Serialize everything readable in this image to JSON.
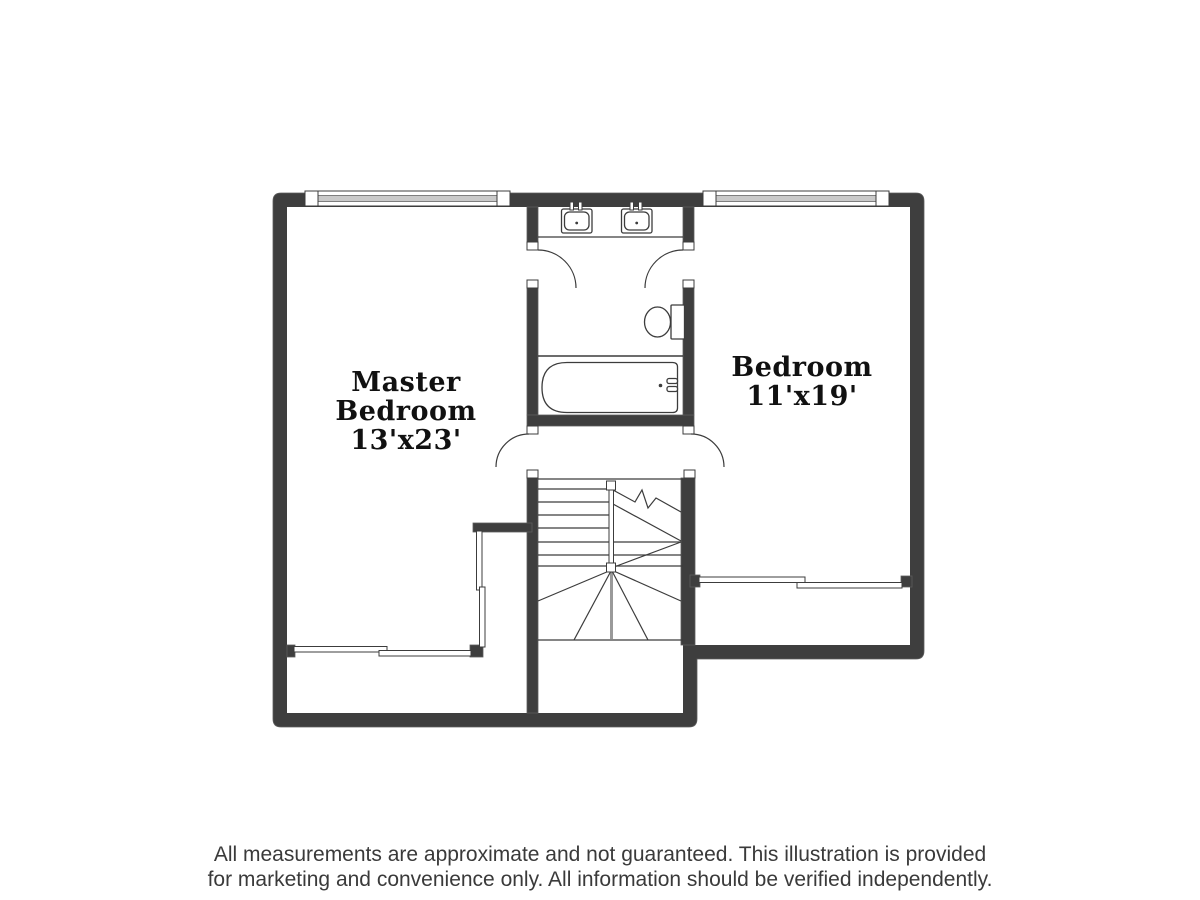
{
  "floor_plan": {
    "rooms": {
      "master_bedroom": {
        "line1": "Master",
        "line2": "Bedroom",
        "dims": "13'x23'"
      },
      "bedroom": {
        "line1": "Bedroom",
        "dims": "11'x19'"
      }
    },
    "fixtures": [
      "sink",
      "sink",
      "toilet",
      "bathtub",
      "staircase",
      "window",
      "window",
      "sliding-closet-doors"
    ],
    "disclaimer": {
      "line1": "All measurements are approximate and not guaranteed. This illustration is provided",
      "line2": "for marketing and convenience only. All information should be verified independently."
    },
    "colors": {
      "wall": "#3e3e3e",
      "wall_edge": "#5d5d5d",
      "line": "#3c3c3c",
      "window_stripe": "#c9c9c9",
      "text": "#111111",
      "disclaimer_text": "#3a3a3a",
      "stair_rail_gray": "#9a9a9a"
    }
  }
}
